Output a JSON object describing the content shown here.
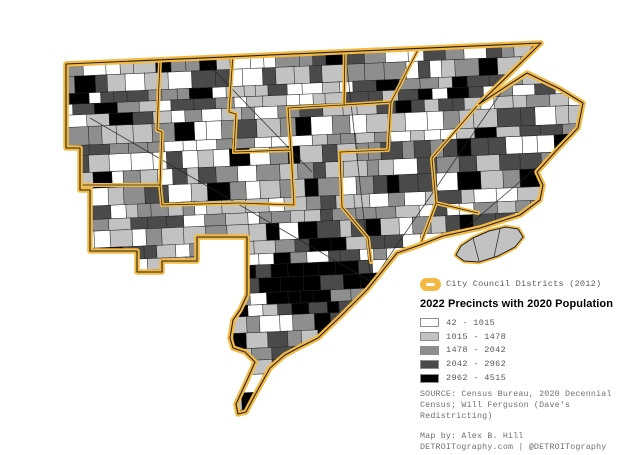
{
  "legend": {
    "districts_label": "City Council Districts (2012)",
    "title": "2022 Precincts with 2020 Population",
    "classes": [
      {
        "label": "42 - 1015",
        "color": "#FFFFFF"
      },
      {
        "label": "1015 - 1478",
        "color": "#C2C2C2"
      },
      {
        "label": "1478 - 2042",
        "color": "#8E8E8E"
      },
      {
        "label": "2042 - 2962",
        "color": "#4A4A4A"
      },
      {
        "label": "2962 - 4515",
        "color": "#000000"
      }
    ],
    "source_lines": [
      "SOURCE: Census Bureau, 2020 Decennial",
      "Census; Will Ferguson (Dave's",
      "Redistricting)"
    ],
    "credit_lines": [
      "Map by: Alex B. Hill",
      "DETROITography.com | @DETROITography"
    ]
  },
  "colors": {
    "council_district_outline": "#F4B942",
    "precinct_border": "#222222",
    "background": "#FFFFFF",
    "legend_text": "#5A5A5A",
    "note_text": "#707070"
  }
}
